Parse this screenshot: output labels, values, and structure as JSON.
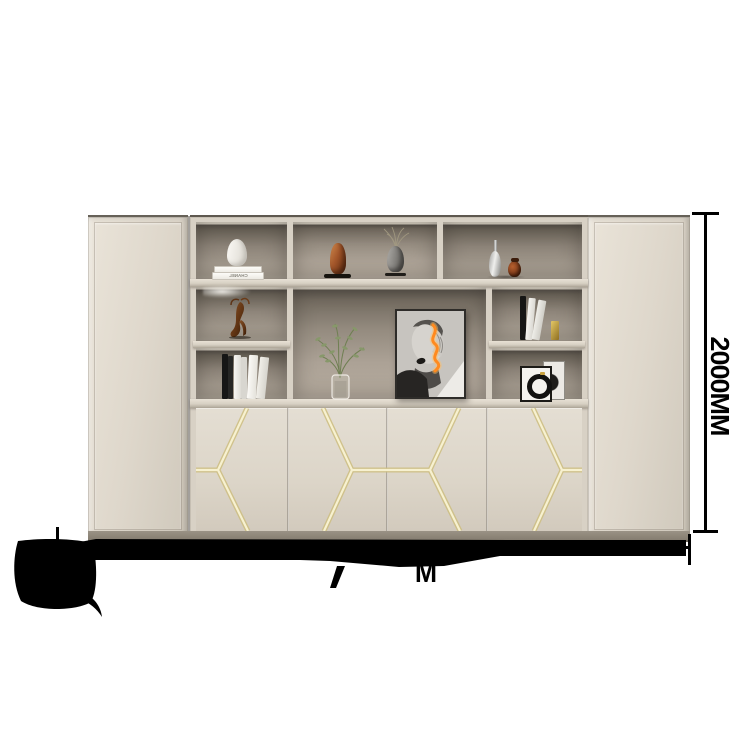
{
  "scene": {
    "type": "furniture product photo with dimension annotations",
    "background_color": "#ffffff"
  },
  "cabinet": {
    "body_color": "#ddd6ca",
    "interior_color": "#8c8478",
    "gold_inlay_color": "#e9dfa9",
    "plinth_color": "#90887b",
    "left_unit": "tall closed wardrobe door",
    "right_unit": "tall closed wardrobe door",
    "center_unit": "open shelving over 4-door base cabinet with gold hexagon inlay",
    "shelf_decor": {
      "chanel_book_label": "CHANEL",
      "items": [
        "white vase on white books",
        "bronze hand sculpture",
        "bust sculpture with dried grass",
        "silver teardrop vase",
        "amber bottle vase",
        "bronze gazelle figurine",
        "standing books with gold bookend",
        "stack of black and white books",
        "black-and-white portrait art print with orange neon squiggle",
        "green branch in glass vase",
        "small framed circular artwork"
      ]
    }
  },
  "annotations": {
    "height_dimension": "2000MM",
    "width_dimension_visible_fragment": "M",
    "line_color": "#000000"
  },
  "redaction": {
    "color": "#000000",
    "areas": [
      "irregular blob over bottom-left logo with curved tail",
      "long horizontal marker stroke covering the width dimension text"
    ]
  }
}
